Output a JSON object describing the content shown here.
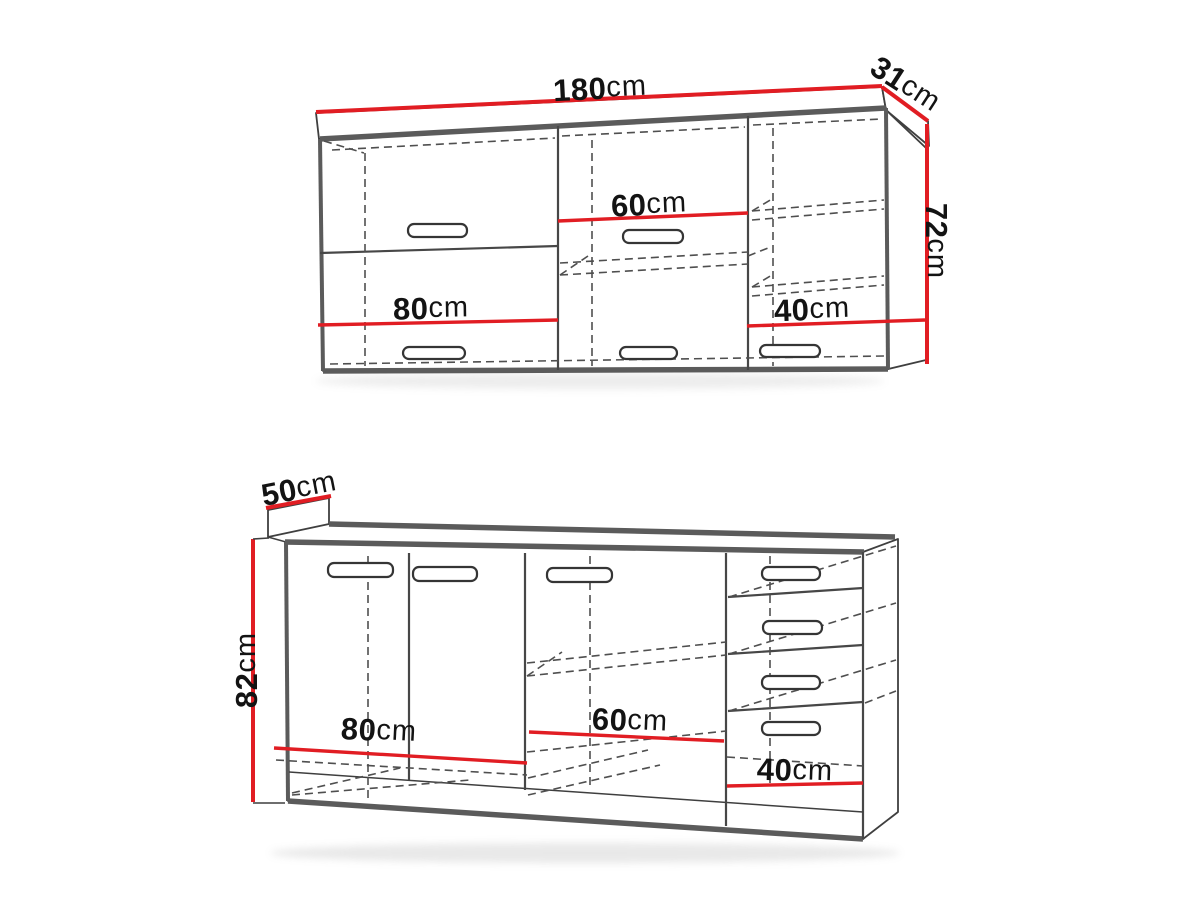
{
  "diagram": {
    "title": "Kitchen cabinet set dimension drawing",
    "unit": "cm",
    "colors": {
      "dimension_line": "#e11d23",
      "outline_thick": "#5b5b5b",
      "outline_thin": "#3f3f3f",
      "label_text": "#131313",
      "background": "#ffffff"
    },
    "wall_cabinet": {
      "width": {
        "num": "180",
        "unit": "cm"
      },
      "depth": {
        "num": "31",
        "unit": "cm"
      },
      "height": {
        "num": "72",
        "unit": "cm"
      },
      "section_left": {
        "num": "80",
        "unit": "cm"
      },
      "section_middle": {
        "num": "60",
        "unit": "cm"
      },
      "section_right": {
        "num": "40",
        "unit": "cm"
      }
    },
    "base_cabinet": {
      "depth": {
        "num": "50",
        "unit": "cm"
      },
      "height": {
        "num": "82",
        "unit": "cm"
      },
      "section_left": {
        "num": "80",
        "unit": "cm"
      },
      "section_middle": {
        "num": "60",
        "unit": "cm"
      },
      "section_right": {
        "num": "40",
        "unit": "cm"
      }
    }
  }
}
